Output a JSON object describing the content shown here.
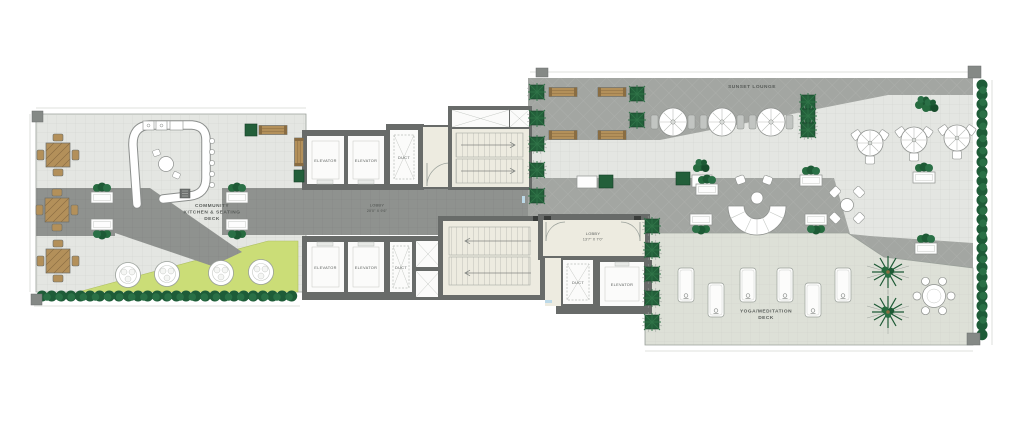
{
  "areas": {
    "community": {
      "line1": "COMMUNITY",
      "line2": "KITCHEN & SEATING",
      "line3": "DECK"
    },
    "sunset": {
      "label": "SUNSET LOUNGE"
    },
    "yoga": {
      "line1": "YOGA/MEDITATION",
      "line2": "DECK"
    },
    "lobby_main": {
      "name": "LOBBY",
      "dim": "20'0\" X 9'6\""
    },
    "lobby_upper": {
      "name": "LOBBY",
      "dim": "13'7\" X 7'0\""
    }
  },
  "rooms": {
    "elevator": "ELEVATOR",
    "duct": "DUCT"
  },
  "colors": {
    "deck": "#e4e6e2",
    "deck-dark": "#a3a6a2",
    "corridor": "#8f928f",
    "lawn": "#cbdd77",
    "hedge": "#1e5c38",
    "wood": "#b3905a",
    "wall": "#686b69",
    "room": "#edebe0",
    "planter": "#235f3a",
    "paper": "#ffffff"
  }
}
